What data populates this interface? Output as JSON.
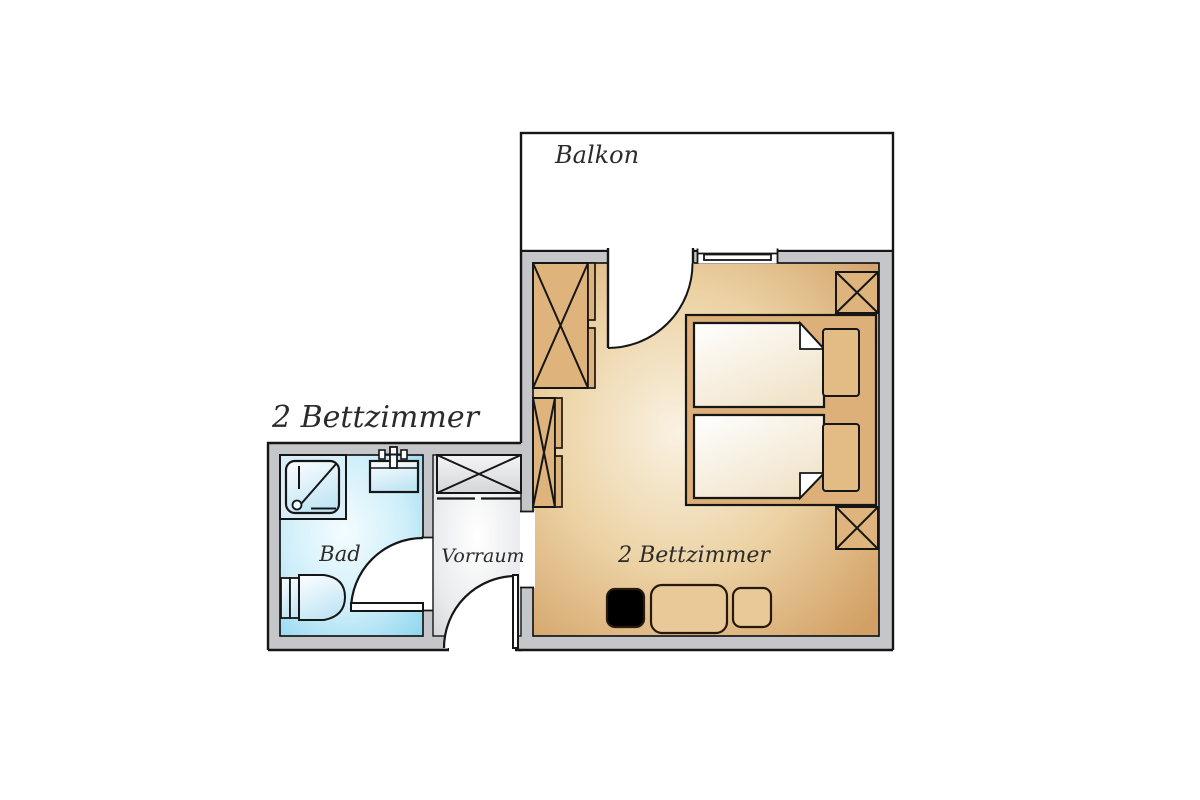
{
  "plan": {
    "title": "2 Bettzimmer",
    "type": "floor-plan"
  },
  "labels": {
    "title": "2 Bettzimmer",
    "balcony": "Balkon",
    "bathroom": "Bad",
    "vestibule": "Vorraum",
    "bedroom": "2 Bettzimmer"
  },
  "rooms": [
    {
      "name": "Balkon",
      "floor_color": "#ffffff"
    },
    {
      "name": "2 Bettzimmer",
      "floor_color_center": "#f8f1e1",
      "floor_color_edge": "#d2a065",
      "furniture": [
        "wardrobe",
        "wardrobe",
        "closet-x",
        "closet-x",
        "double-bed",
        "pillow",
        "pillow",
        "chair",
        "table",
        "chair"
      ]
    },
    {
      "name": "Bad",
      "floor_color_center": "#f4fcff",
      "floor_color_edge": "#8ed5ee",
      "furniture": [
        "shower",
        "sink",
        "toilet"
      ]
    },
    {
      "name": "Vorraum",
      "floor_color_center": "#ffffff",
      "floor_color_edge": "#cbcdd2",
      "furniture": [
        "closet-x"
      ]
    }
  ],
  "colors": {
    "wall": "#c5c6c9",
    "outline": "#161616",
    "furniture_tan": "#dfb47c",
    "bed_frame": "#dcb078",
    "pillow": "#e3bc85",
    "fixture_blue": "#cfeaf7",
    "balcony": "#ffffff"
  }
}
